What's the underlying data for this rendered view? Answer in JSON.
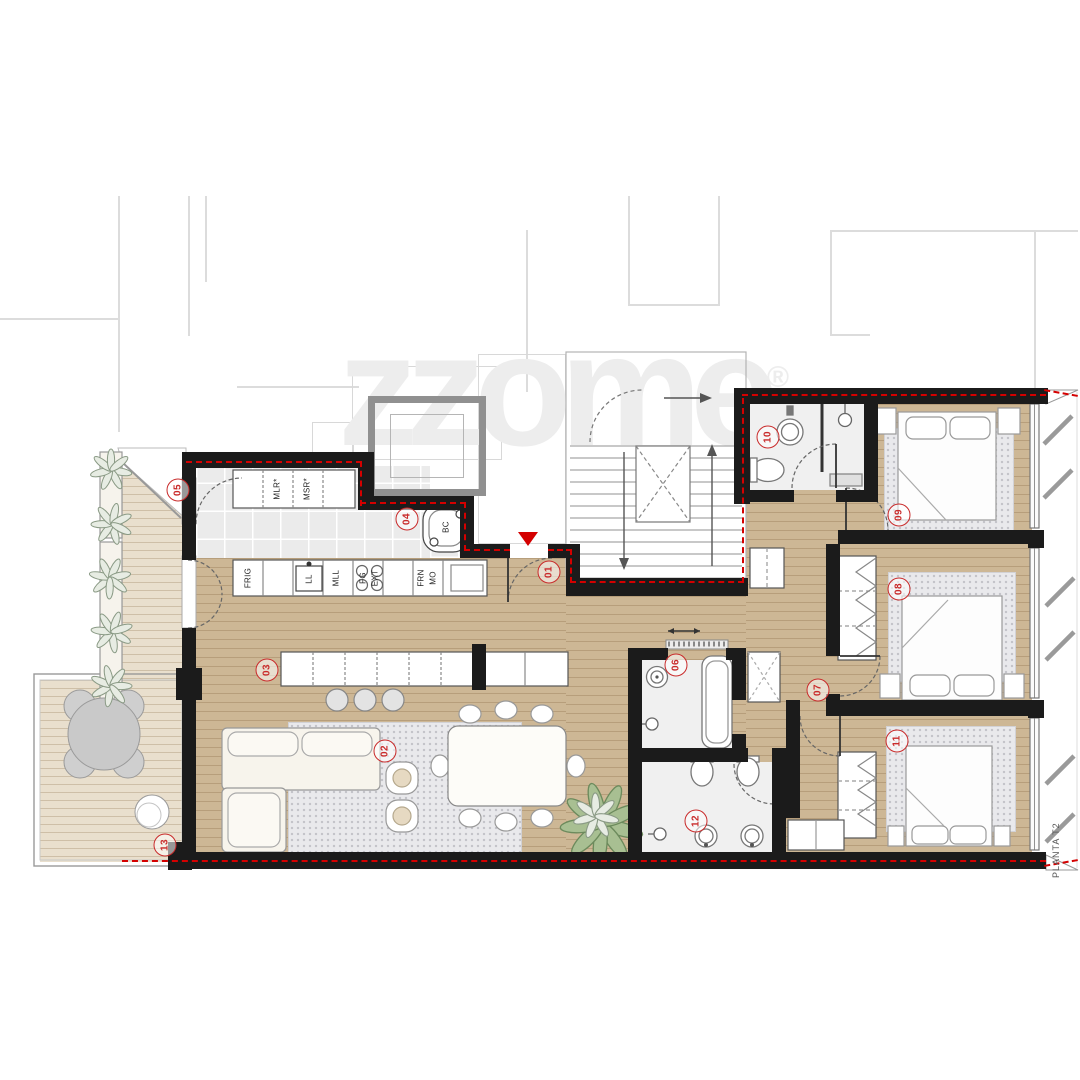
{
  "watermark": {
    "brand": "zzome",
    "registered": "®"
  },
  "side_label": "PLANTA T2",
  "markers": [
    {
      "label": "01"
    },
    {
      "label": "02"
    },
    {
      "label": "03"
    },
    {
      "label": "04"
    },
    {
      "label": "05"
    },
    {
      "label": "06"
    },
    {
      "label": "07"
    },
    {
      "label": "08"
    },
    {
      "label": "09"
    },
    {
      "label": "10"
    },
    {
      "label": "11"
    },
    {
      "label": "12"
    },
    {
      "label": "13"
    }
  ],
  "kitchen_labels": {
    "mlr": "MLR*",
    "msr": "MSR*",
    "frig": "FRIG",
    "ll": "LL",
    "mll": "MLL",
    "fg": "FG",
    "ext": "EXT",
    "frn": "FRN",
    "mo": "MO",
    "bc": "BC"
  },
  "colors": {
    "accent_red": "#d40000",
    "wall_black": "#1b1b1b",
    "wood_floor": "#cdb795",
    "deck_floor": "#e9dfcd",
    "tile_floor": "#ebebeb"
  }
}
